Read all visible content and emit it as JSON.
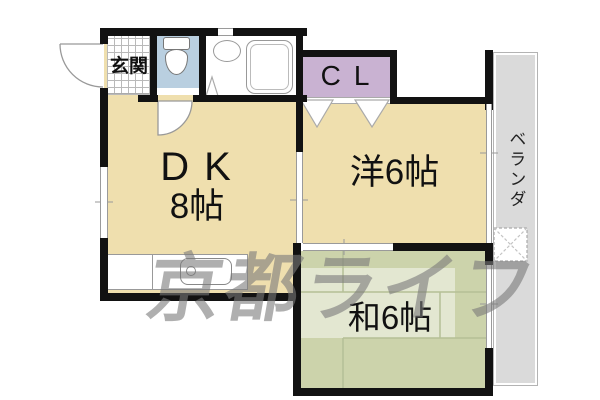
{
  "page": {
    "kind": "real-estate-floorplan",
    "width_px": 600,
    "height_px": 400
  },
  "watermark": {
    "text": "京都ライフ",
    "color": "#7a7a7a"
  },
  "rooms": {
    "entrance": {
      "label": "玄関"
    },
    "dining_kitchen": {
      "label": "DK",
      "size": "8帖",
      "color": "#efdfae"
    },
    "western_room": {
      "label": "洋6帖",
      "color": "#efdfae"
    },
    "japanese_room": {
      "label": "和6帖",
      "color": "#ccd3ab"
    },
    "closet": {
      "label": "CL",
      "color": "#c9b2d2"
    },
    "toilet_room": {
      "color": "#b9cfe0"
    },
    "veranda": {
      "label": "ベランダ",
      "color": "#dadada"
    }
  },
  "fixtures": [
    "entrance-door-swing",
    "toilet",
    "toilet-door-swing",
    "wash-basin",
    "bathtub",
    "bath-folding-door",
    "kitchen-counter",
    "kitchen-sink",
    "closet-folding-doors",
    "washing-machine-pan",
    "windows",
    "sliding-doors"
  ],
  "style": {
    "wall_color": "#121212",
    "tatami_line_color": "#b5bf96"
  }
}
